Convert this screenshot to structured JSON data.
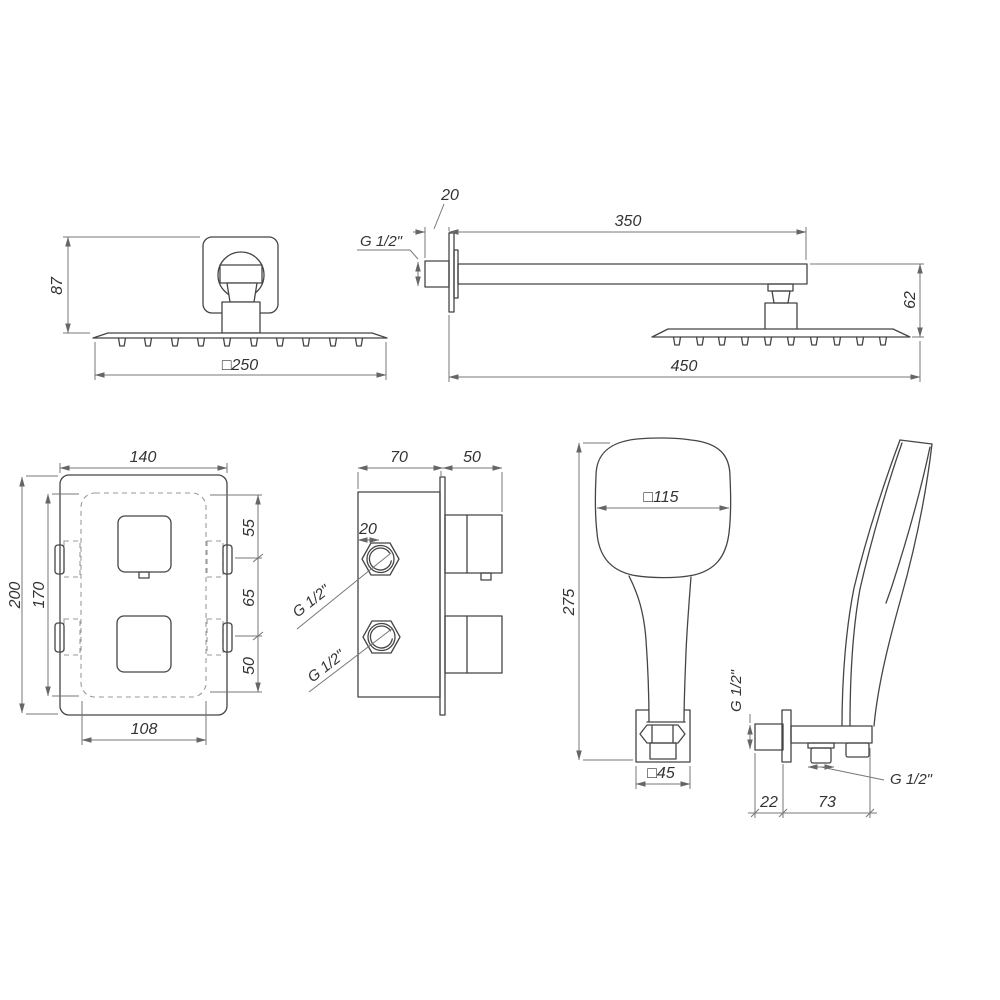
{
  "page": {
    "background": "#ffffff",
    "line_color": "#454545",
    "dim_color": "#777777"
  },
  "drawing_type": "shower-set-technical-dimension-drawing",
  "views": {
    "overhead_shower_front": {
      "height": "87",
      "width": "□250"
    },
    "shower_arm_side": {
      "wall_fitting": "20",
      "thread": "G 1/2\"",
      "arm_length": "350",
      "head_drop": "62",
      "total_reach": "450"
    },
    "mixer_front": {
      "width": "140",
      "height": "200",
      "plate_height": "170",
      "top_offset": "55",
      "knob_spacing": "65",
      "bottom_offset": "50",
      "plate_width": "108"
    },
    "mixer_side": {
      "body_depth": "70",
      "knob_depth": "50",
      "port_size": "20",
      "upper_thread": "G 1/2\"",
      "lower_thread": "G 1/2\""
    },
    "hand_shower_front": {
      "head_width": "□115",
      "length": "275",
      "holder_width": "□45"
    },
    "wall_outlet_side": {
      "thread_wall": "G 1/2\"",
      "thread_bottom": "G 1/2\"",
      "wall_offset": "22",
      "body_length": "73"
    }
  }
}
